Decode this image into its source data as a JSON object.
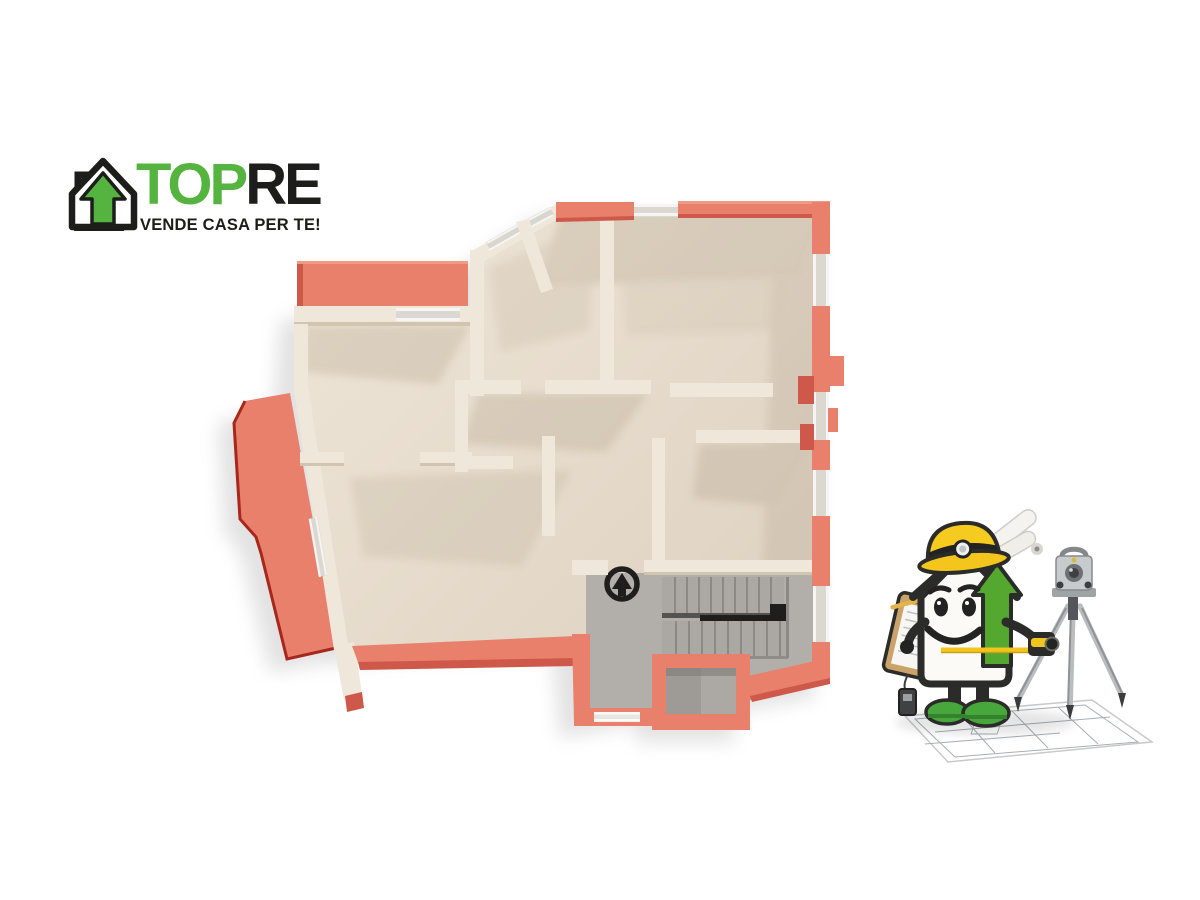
{
  "page": {
    "background": "#ffffff"
  },
  "logo": {
    "brand_primary": "TOP",
    "brand_secondary": "RE",
    "tagline": "VENDE CASA PER TE!",
    "icon": "house-arrow-up-icon",
    "colors": {
      "green": "#55B43F",
      "black": "#1D1D1B"
    }
  },
  "floor_plan": {
    "description": "3D top-down rendered floor plan of an apartment",
    "north_indicator": "arrow-up-circle-icon",
    "features": [
      "terrace-left",
      "terrace-top",
      "living-room",
      "bedrooms",
      "hallway",
      "staircase",
      "small-room"
    ],
    "colors": {
      "coral": "#E8806C",
      "coral_dark": "#CE584A",
      "coral_light": "#F09983",
      "coral_edge": "#A8271C",
      "cream": "#EFE7D9",
      "cream_shadow": "#D2C5B0",
      "floor_light": "#EFE6D8",
      "floor_dark": "#DCCFBE",
      "window_glass": "#DBD7D1",
      "window_frame": "#F6F5F3",
      "hall_gray": "#B2AFAA",
      "stair_gray": "#ABA8A3",
      "tread_line": "#8C8984",
      "ink": "#1F1E1C"
    }
  },
  "mascot": {
    "description": "House mascot surveyor with hard hat, clipboard, tape measure, theodolite on tripod, standing on blueprint",
    "parts": [
      "hard-hat",
      "head-lamp",
      "house-body",
      "green-arrow",
      "smile-face",
      "clipboard",
      "pencil",
      "tape-measure",
      "paper-rolls",
      "tripod",
      "theodolite",
      "blueprint"
    ],
    "colors": {
      "hat_yellow": "#F3C51D",
      "arrow_green": "#54A82F",
      "shoe_green": "#47A63C",
      "outline": "#2B2B29",
      "body_white": "#FBFAF6",
      "tripod_silver": "#C7CBCE",
      "clipboard_tan": "#C9A36A",
      "tape_yellow": "#F2C51D"
    }
  }
}
